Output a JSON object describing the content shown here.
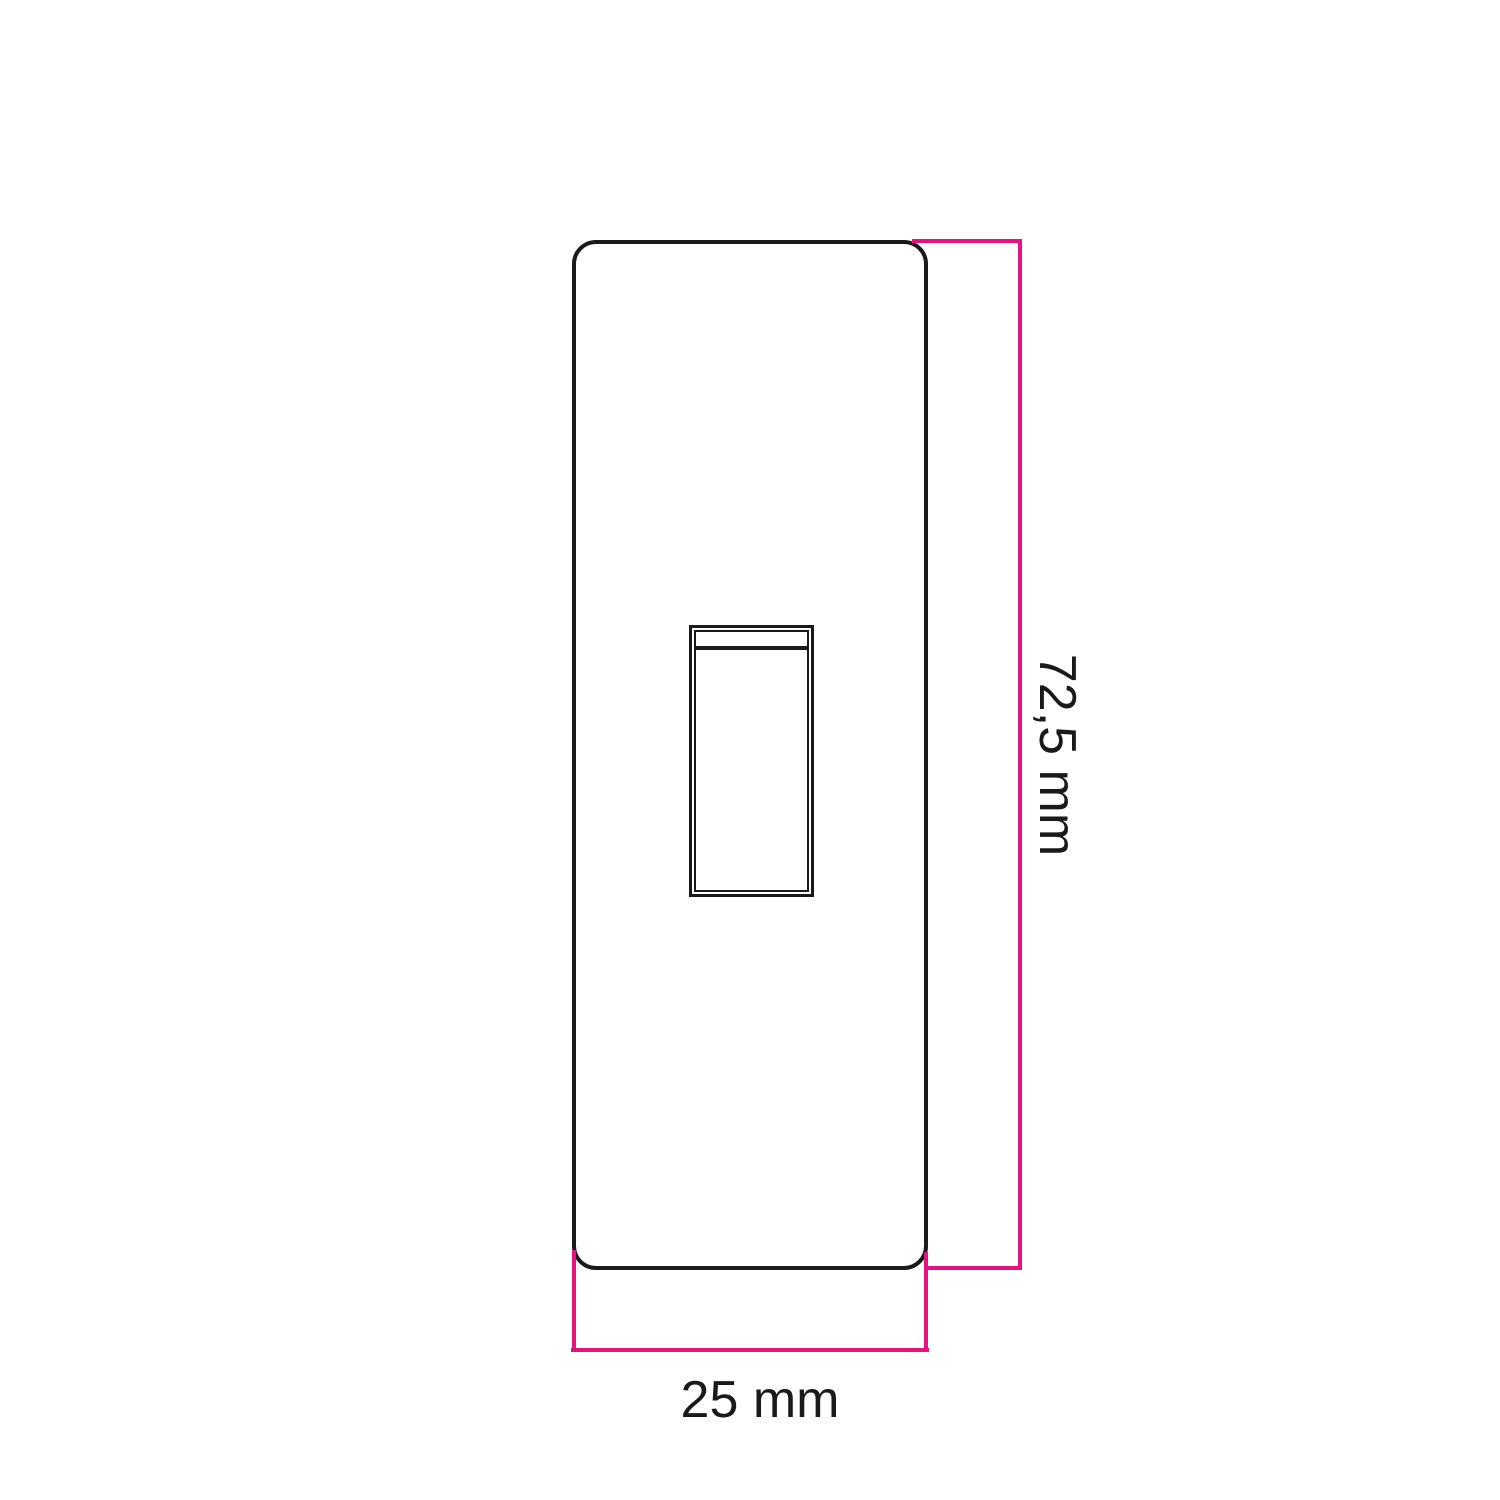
{
  "diagram": {
    "type": "technical-dimension-drawing",
    "subject": "single rocker switch plate, front view",
    "part": {
      "plate": "rounded rectangular switch plate outline",
      "control": "rocker switch button with inner frame and top edge band"
    },
    "dimensions": {
      "height": {
        "value": "72,5",
        "unit": "mm",
        "label": "72,5 mm"
      },
      "width": {
        "value": "25",
        "unit": "mm",
        "label": "25 mm"
      }
    },
    "colors": {
      "background": "#ffffff",
      "outline": "#1a1a1a",
      "dimension_line": "#e6127f",
      "label_text": "#1a1a1a"
    }
  }
}
